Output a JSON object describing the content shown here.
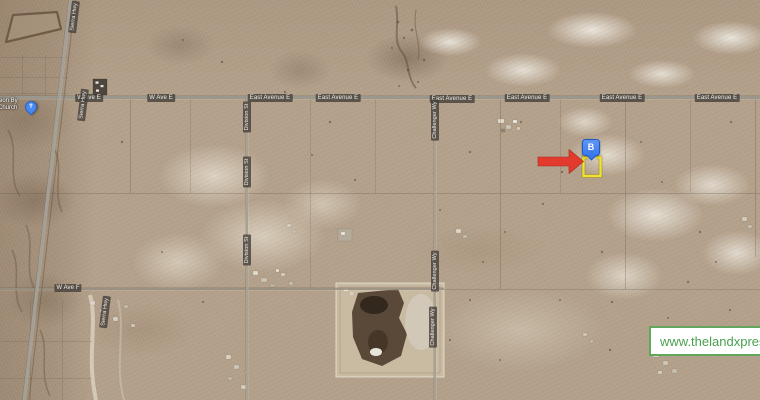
{
  "map": {
    "type": "satellite",
    "road_labels": {
      "w_ave_e": "W Ave E",
      "east_avenue_e": "East Avenue E",
      "w_ave_f": "W Ave F",
      "division_st": "Division St",
      "challenger_wy": "Challenger Wy",
      "sierra_hwy": "Sierra Hwy"
    },
    "poi": {
      "church_label_line1": "sion By",
      "church_label_line2": "Church",
      "church_pin_glyph": "✝"
    }
  },
  "annotations": {
    "pin_label": "B",
    "parcel_outline_color": "#f1e32b",
    "arrow_color": "#e23b2e",
    "pin_blue": "#3c79ea"
  },
  "watermark": {
    "text": "www.thelandxpress.",
    "color": "#4aa04f"
  }
}
